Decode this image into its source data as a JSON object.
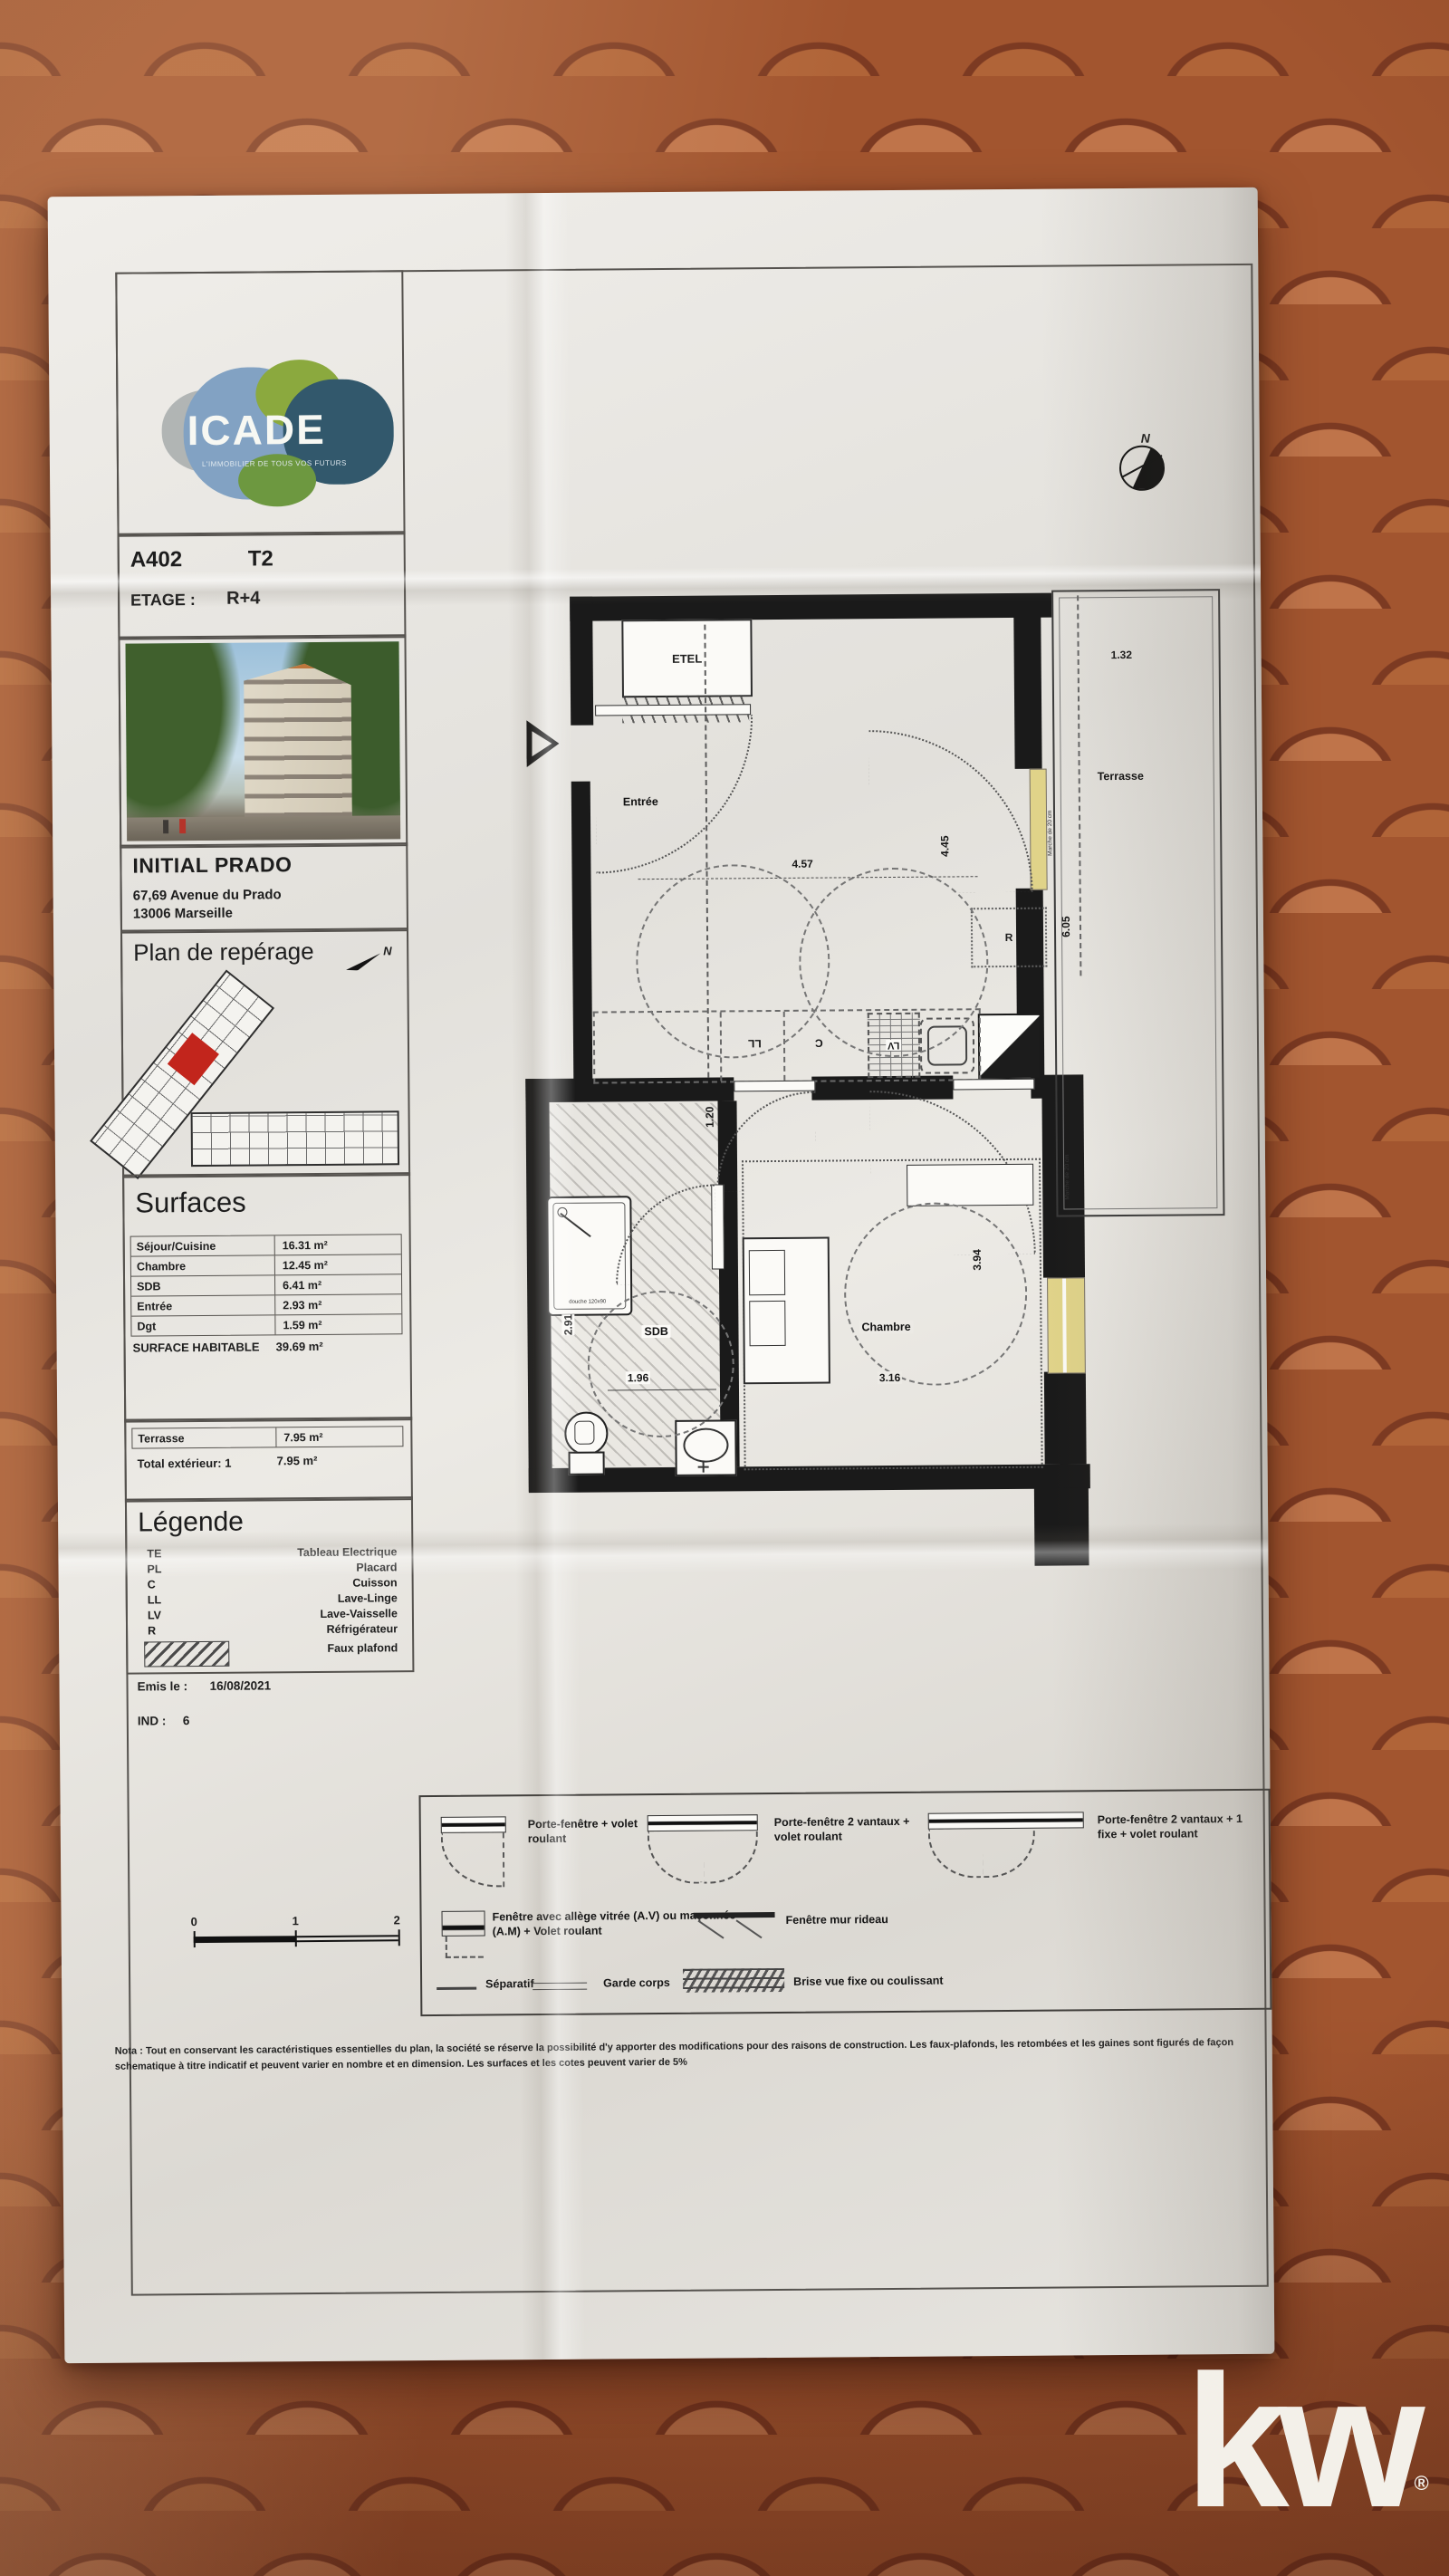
{
  "brand": {
    "name": "ICADE",
    "tagline": "L'IMMOBILIER DE TOUS VOS FUTURS"
  },
  "header": {
    "unit": "A402",
    "unit_type": "T2",
    "floor_label": "ETAGE :",
    "floor_value": "R+4"
  },
  "project": {
    "name": "INITIAL PRADO",
    "address1": "67,69 Avenue du Prado",
    "address2": "13006 Marseille"
  },
  "reperage": {
    "title": "Plan de repérage",
    "north": "N"
  },
  "surfaces": {
    "title": "Surfaces",
    "rows": [
      {
        "label": "Séjour/Cuisine",
        "value": "16.31 m²"
      },
      {
        "label": "Chambre",
        "value": "12.45 m²"
      },
      {
        "label": "SDB",
        "value": "6.41 m²"
      },
      {
        "label": "Entrée",
        "value": "2.93 m²"
      },
      {
        "label": "Dgt",
        "value": "1.59 m²"
      }
    ],
    "total_label": "SURFACE HABITABLE",
    "total_value": "39.69 m²"
  },
  "exterior": {
    "rows": [
      {
        "label": "Terrasse",
        "value": "7.95 m²"
      },
      {
        "label": "Total extérieur: 1",
        "value": "7.95 m²"
      }
    ]
  },
  "legende": {
    "title": "Légende",
    "items": [
      {
        "code": "TE",
        "label": "Tableau Electrique"
      },
      {
        "code": "PL",
        "label": "Placard"
      },
      {
        "code": "C",
        "label": "Cuisson"
      },
      {
        "code": "LL",
        "label": "Lave-Linge"
      },
      {
        "code": "LV",
        "label": "Lave-Vaisselle"
      },
      {
        "code": "R",
        "label": "Réfrigérateur"
      }
    ],
    "hatch_label": "Faux plafond"
  },
  "issue": {
    "emitted_label": "Emis le :",
    "emitted_value": "16/08/2021",
    "index_label": "IND :",
    "index_value": "6"
  },
  "scalebar": {
    "t0": "0",
    "t1": "1",
    "t2": "2"
  },
  "plan": {
    "compass_n": "N",
    "labels": {
      "etel": "ETEL",
      "entree": "Entrée",
      "terrasse": "Terrasse",
      "sdb": "SDB",
      "chambre": "Chambre",
      "fridge": "R",
      "cooktop": "C",
      "washer": "LL",
      "dishwasher": "LV"
    },
    "dims": {
      "d457": "4.57",
      "d132": "1.32",
      "d605": "6.05",
      "d445": "4.45",
      "d120": "1.20",
      "d291": "2.91",
      "d196": "1.96",
      "d316": "3.16",
      "d394": "3.94"
    },
    "notes": {
      "step": "Marche de 20 cm",
      "shower": "douche 120x90"
    }
  },
  "symbols": {
    "items": [
      {
        "label": "Porte-fenêtre + volet roulant"
      },
      {
        "label": "Porte-fenêtre 2 vantaux + volet roulant"
      },
      {
        "label": "Porte-fenêtre 2 vantaux + 1 fixe + volet roulant"
      },
      {
        "label": "Fenêtre avec allège vitrée (A.V) ou maçonnée (A.M) + Volet roulant"
      },
      {
        "label": "Fenêtre mur rideau"
      },
      {
        "label": "Séparatif"
      },
      {
        "label": "Garde corps"
      },
      {
        "label": "Brise vue fixe ou coulissant"
      }
    ]
  },
  "nota": {
    "text": "Nota : Tout en conservant les caractéristiques essentielles du plan, la société se réserve la possibilité d'y apporter des modifications pour des raisons de construction. Les faux-plafonds, les retombées et les gaines sont figurés de façon schematique à titre indicatif et peuvent varier en nombre et en dimension. Les surfaces et les cotes peuvent varier de 5%"
  },
  "watermark": {
    "logo": "kw",
    "reg": "®"
  }
}
